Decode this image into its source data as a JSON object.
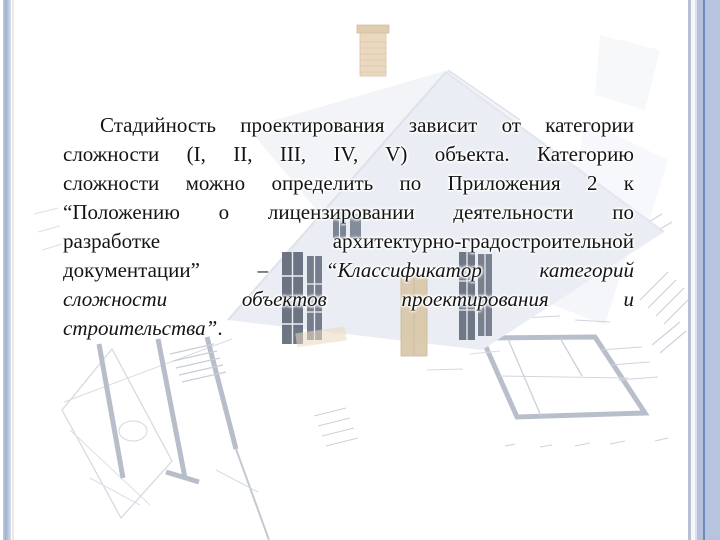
{
  "slide": {
    "type": "presentation-slide",
    "language": "ru",
    "text_color": "#141414",
    "paragraph": {
      "font_size_px": 21,
      "line_height_px": 29,
      "first_line_indent_px": 37,
      "lines": [
        {
          "justify": true,
          "indent": true,
          "segments": [
            {
              "text": "Стадийность проектирования зависит от категории",
              "italic": false
            }
          ]
        },
        {
          "justify": true,
          "indent": false,
          "segments": [
            {
              "text": "сложности (I, II, III, IV, V) объекта. Категорию",
              "italic": false
            }
          ]
        },
        {
          "justify": true,
          "indent": false,
          "segments": [
            {
              "text": "сложности можно определить по Приложения 2 к",
              "italic": false
            }
          ]
        },
        {
          "justify": true,
          "indent": false,
          "segments": [
            {
              "text": "“Положению о лицензировании деятельности по",
              "italic": false
            }
          ]
        },
        {
          "justify": true,
          "indent": false,
          "segments": [
            {
              "text": "разработке архитектурно-градостроительной",
              "italic": false
            }
          ]
        },
        {
          "justify": true,
          "indent": false,
          "segments": [
            {
              "text": "документации” – ",
              "italic": false
            },
            {
              "text": "“Классификатор категорий",
              "italic": true
            }
          ]
        },
        {
          "justify": true,
          "indent": false,
          "segments": [
            {
              "text": "сложности объектов проектирования и",
              "italic": true
            }
          ]
        },
        {
          "justify": false,
          "indent": false,
          "segments": [
            {
              "text": "строительства”",
              "italic": true
            },
            {
              "text": ".",
              "italic": false
            }
          ]
        }
      ]
    },
    "frame": {
      "left_stripe_colors": [
        "#c2cddd",
        "#9fb2cf",
        "#d8dfeb"
      ],
      "left_accent_line_color": "#f3e6e6",
      "right_inner_stripe_color": "#b6c0d2",
      "right_inner_light_color": "#f6f6fb",
      "right_lavender_color": "#dcdfee",
      "right_band_inner_color": "#b3c1dd",
      "right_divider_color": "#6f88bb",
      "right_band_color": "#b7c4de"
    },
    "background_art": {
      "description": "faint architectural collage: 3D house rendering with brick chimney, dark mullioned windows, tan door, and tilted blueprint floor plans with hatch marks",
      "roof_color": "#eaedf3",
      "back_gable_color": "#f2f4f8",
      "chimney_color": "#ead9c0",
      "window_color": "#5f6879",
      "door_color": "#d9c7a7",
      "plan_wall_color": "#b9bfca",
      "plan_thin_line_color": "#d0d4dc",
      "hatch_line_color": "#cdd2db"
    }
  }
}
